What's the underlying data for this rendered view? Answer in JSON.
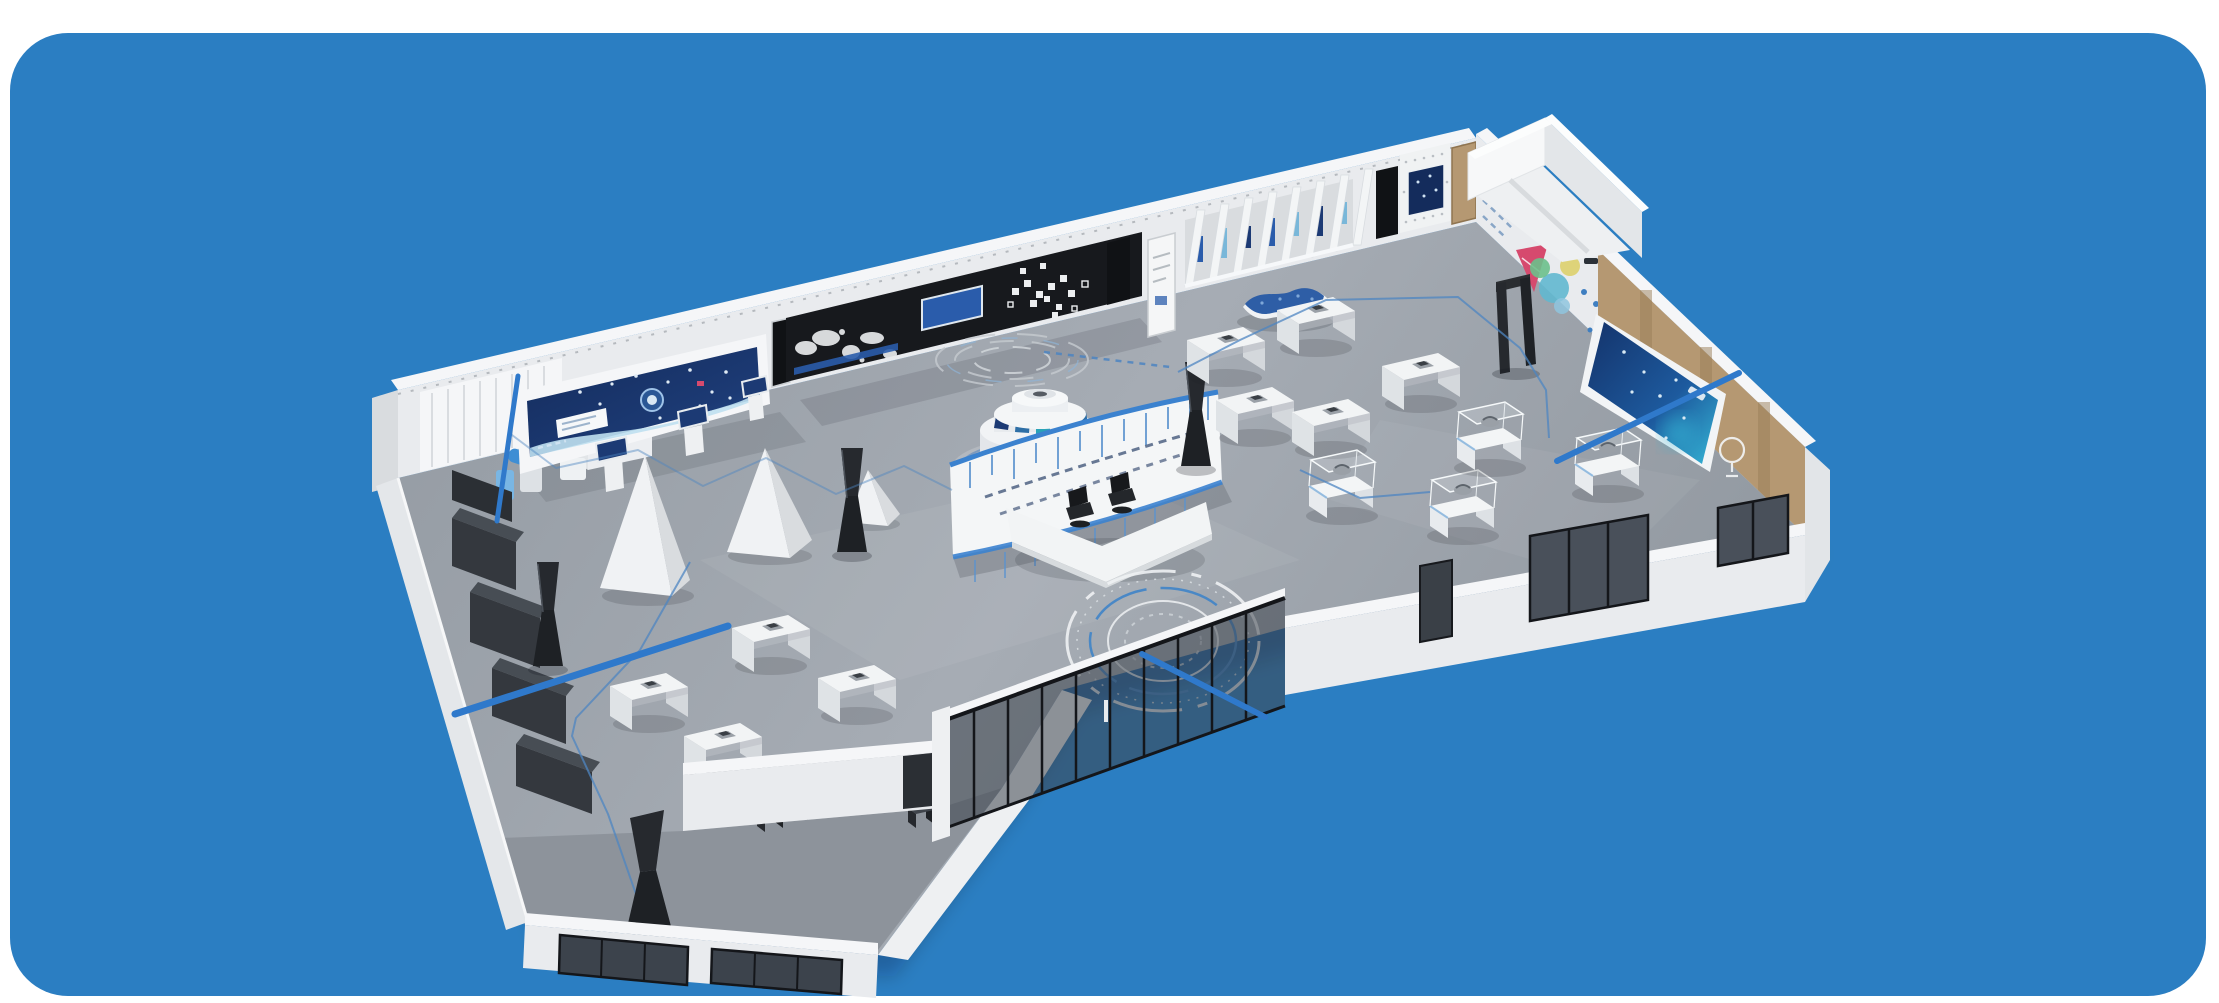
{
  "scene": {
    "description": "Isometric 3D rendering of a smart technology exhibition hall inside a rounded blue panel",
    "colors": {
      "page_bg": "#ffffff",
      "panel_bg": "#2b7ec2",
      "floor": "#939aa2",
      "floor_light": "#a6acb4",
      "wing_floor": "#8d939b",
      "wall": "#e9ebee",
      "wall_bright": "#f5f6f8",
      "wall_shade": "#d9dcdf",
      "wall_edge": "#cfd3d7",
      "black_panel": "#17191d",
      "door_dark": "#101215",
      "navy_screen": "#1c3a74",
      "navy_deep": "#142c5c",
      "screen_glow": "#35b6d6",
      "light_strip": "#bfe0f0",
      "inset_blue": "#2a5cab",
      "wood": "#b59872",
      "wood_dark": "#9a7e57",
      "glass": "#3c434c",
      "glass_frame": "#14161a",
      "accent_line": "#2f79cb",
      "path_line": "#4d85c2",
      "trim_blue": "#3b82cf",
      "bench_blue": "#2e5ea6",
      "dark_object": "#26292e",
      "cabinet": "#34383e",
      "cabinet_top": "#474d54",
      "chair": "#17191c",
      "robot_blue": "#3e8ed4",
      "robot_blue_light": "#79b6e4",
      "info_red": "#d64a6e",
      "info_teal": "#62b8cf",
      "info_green": "#6cc08b",
      "info_yellow": "#ddd06b",
      "ring_white": "#eef1f3",
      "ring_blue": "#3f84c8",
      "ring_gray": "#cfd4d9",
      "shadow": "rgba(15,25,40,0.22)"
    },
    "exhibits": [
      "corner-robot-exhibit",
      "main-led-screen",
      "timeline-wall",
      "world-map-graphic",
      "hexagon-graphics",
      "wall-screen-inset",
      "poster-panel",
      "fin-gallery",
      "pegboard-screen",
      "wood-door",
      "corner-room",
      "infographic-wall",
      "wall-mounted-screen",
      "wavy-bench",
      "central-podium",
      "halo-rings",
      "slogan-partition",
      "reception-desk",
      "office-chairs",
      "triangle-stands",
      "exhibit-tables",
      "display-cases",
      "kiosk-totems",
      "security-gate",
      "storage-cabinets",
      "floor-target-rings",
      "entrance-glass-wall",
      "window-openings",
      "visitor-route-path",
      "annotation-lines"
    ]
  }
}
